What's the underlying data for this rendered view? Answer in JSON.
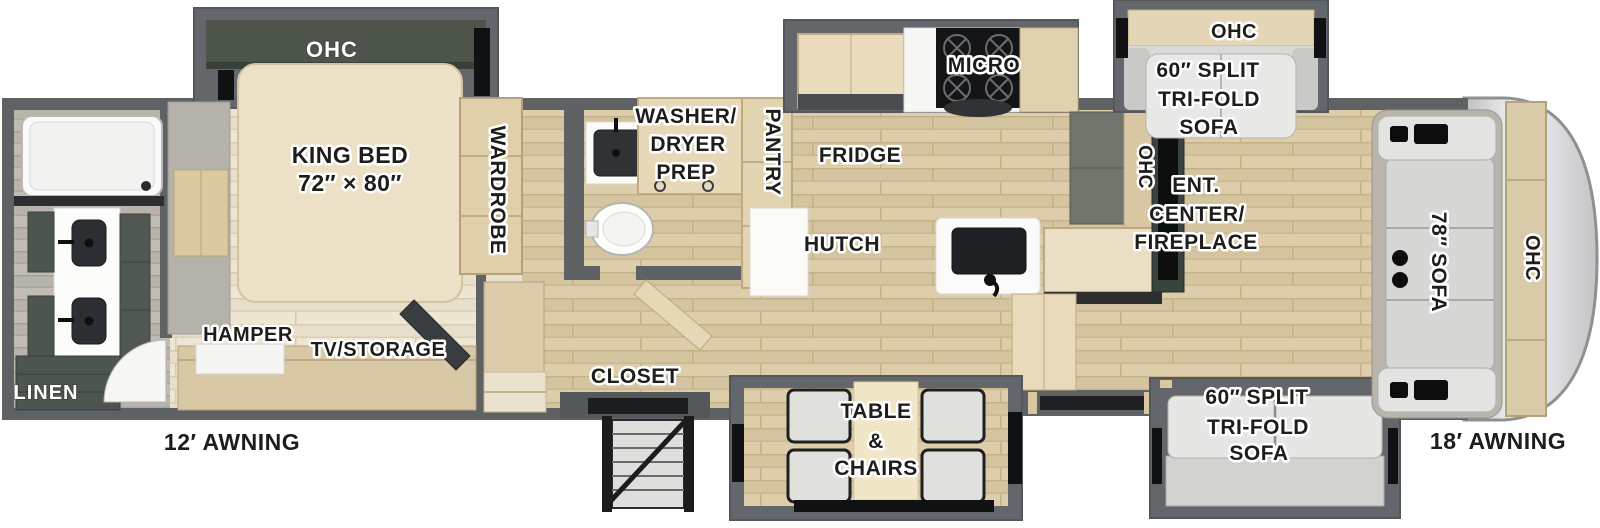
{
  "palette": {
    "wall_gray": "#5f6265",
    "floor_wood": "#d5c4a0",
    "floor_bedroom": "#e8decb",
    "floor_bath": "#b8b4ac",
    "cabinet_wood": "#ddccab",
    "cabinet_green": "#4d564e",
    "sofa_silver": "#d7d7d5",
    "label_black": "#1d1d1b",
    "front_cap_silver": "#dcdddf"
  },
  "bedroom": {
    "ohc": "OHC",
    "king_bed_line1": "KING BED",
    "king_bed_line2": "72″ × 80″",
    "wardrobe": "WARDROBE",
    "hamper": "HAMPER",
    "tv_storage": "TV/STORAGE"
  },
  "rear_bath": {
    "linen": "LINEN"
  },
  "mid_bath": {
    "washer_line1": "WASHER/",
    "washer_line2": "DRYER",
    "washer_line3": "PREP"
  },
  "kitchen": {
    "pantry": "PANTRY",
    "micro": "MICRO",
    "fridge": "FRIDGE",
    "hutch": "HUTCH",
    "ohc": "OHC",
    "closet": "CLOSET"
  },
  "dinette": {
    "line1": "TABLE",
    "line2": "&",
    "line3": "CHAIRS"
  },
  "living": {
    "ohc_top": "OHC",
    "sofa_top_line1": "60″ SPLIT",
    "sofa_top_line2": "TRI-FOLD",
    "sofa_top_line3": "SOFA",
    "ent_line1": "ENT.",
    "ent_line2": "CENTER/",
    "ent_line3": "FIREPLACE",
    "sofa_bottom_line1": "60″ SPLIT",
    "sofa_bottom_line2": "TRI-FOLD",
    "sofa_bottom_line3": "SOFA"
  },
  "front": {
    "sofa_78": "78″ SOFA",
    "ohc": "OHC"
  },
  "exterior": {
    "awning_left": "12′ AWNING",
    "awning_right": "18′ AWNING"
  }
}
